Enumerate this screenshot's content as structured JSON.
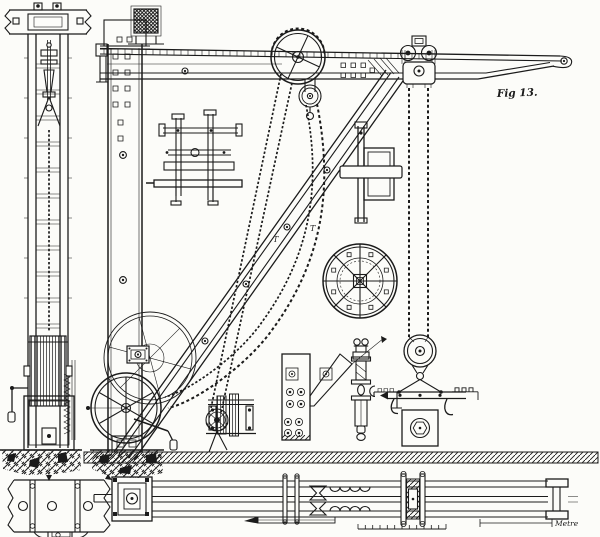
{
  "figure": {
    "fig_label": "Fig 13.",
    "scale_label": "Metre",
    "callouts": {
      "t_left": "T",
      "t_right": "T"
    }
  },
  "palette": {
    "paper": "#fcfcf9",
    "ink": "#1b1b1b"
  }
}
